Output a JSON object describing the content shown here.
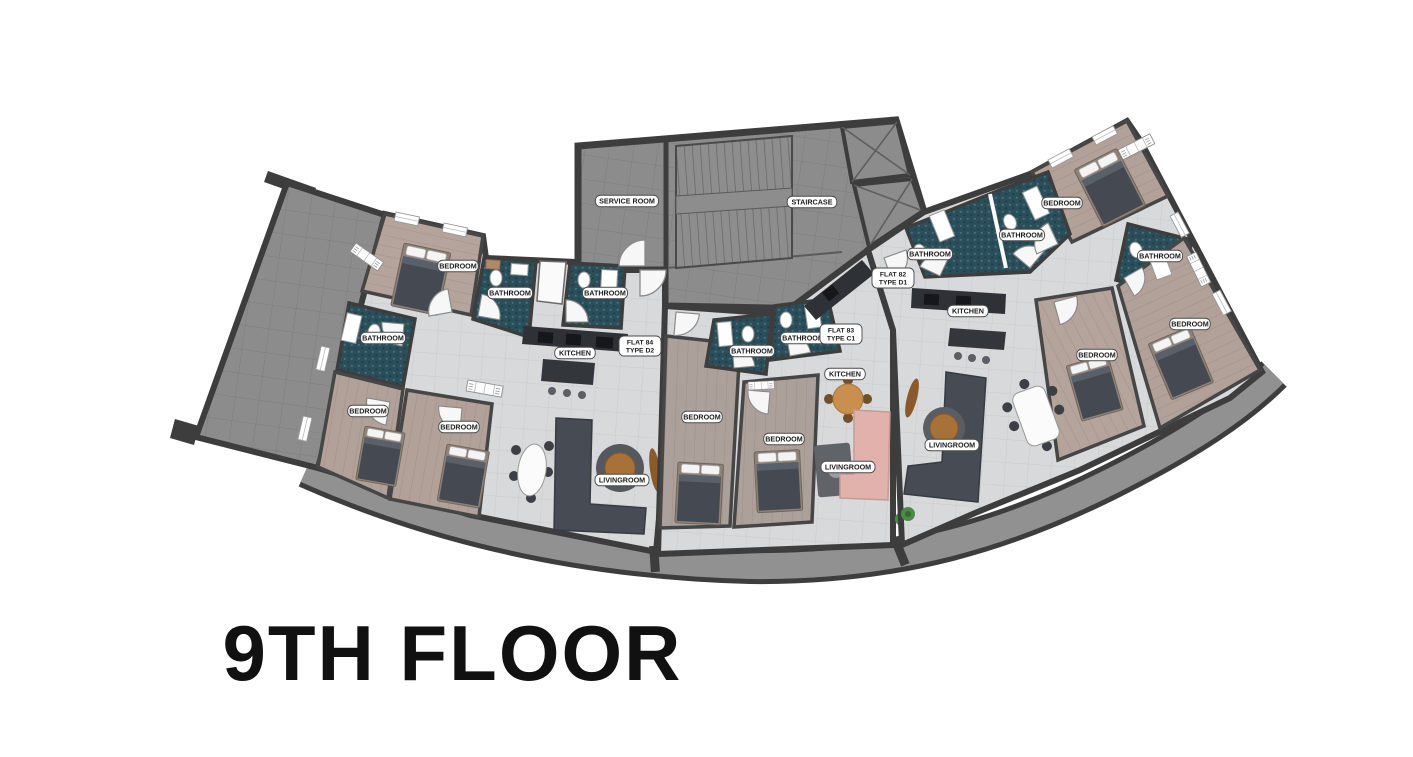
{
  "title": "9TH FLOOR",
  "colors": {
    "wall": "#3d3d3d",
    "terrace_gray": "#8c8c8c",
    "bathroom_teal": "#2b4f5a",
    "bedroom_wood": "#b1a199",
    "living_tile": "#d8d9da",
    "sofa_dark": "#474c54",
    "sofa_pink": "#e0b2ab",
    "table_wood": "#a87137",
    "label_bg": "#ffffff"
  },
  "core": {
    "service_room_label": "SERVICE ROOM",
    "staircase_label": "STAIRCASE"
  },
  "flat_labels": [
    {
      "line1": "FLAT 84",
      "line2": "TYPE D2",
      "x": 640,
      "y": 346
    },
    {
      "line1": "FLAT 83",
      "line2": "TYPE C1",
      "x": 841,
      "y": 334
    },
    {
      "line1": "FLAT 82",
      "line2": "TYPE D1",
      "x": 893,
      "y": 278
    }
  ],
  "room_labels": [
    {
      "text": "SERVICE ROOM",
      "x": 627,
      "y": 201
    },
    {
      "text": "STAIRCASE",
      "x": 812,
      "y": 202
    },
    {
      "text": "BEDROOM",
      "x": 458,
      "y": 266
    },
    {
      "text": "BATHROOM",
      "x": 510,
      "y": 293
    },
    {
      "text": "BATHROOM",
      "x": 605,
      "y": 293
    },
    {
      "text": "BATHROOM",
      "x": 383,
      "y": 338
    },
    {
      "text": "KITCHEN",
      "x": 575,
      "y": 353
    },
    {
      "text": "BEDROOM",
      "x": 368,
      "y": 411
    },
    {
      "text": "BEDROOM",
      "x": 459,
      "y": 427
    },
    {
      "text": "LIVINGROOM",
      "x": 622,
      "y": 480
    },
    {
      "text": "BATHROOM",
      "x": 752,
      "y": 351
    },
    {
      "text": "BATHROOM",
      "x": 803,
      "y": 338
    },
    {
      "text": "KITCHEN",
      "x": 845,
      "y": 374
    },
    {
      "text": "BEDROOM",
      "x": 702,
      "y": 417
    },
    {
      "text": "BEDROOM",
      "x": 784,
      "y": 439
    },
    {
      "text": "LIVINGROOM",
      "x": 848,
      "y": 467
    },
    {
      "text": "BATHROOM",
      "x": 930,
      "y": 254
    },
    {
      "text": "BATHROOM",
      "x": 1022,
      "y": 235
    },
    {
      "text": "BEDROOM",
      "x": 1062,
      "y": 203
    },
    {
      "text": "KITCHEN",
      "x": 968,
      "y": 311
    },
    {
      "text": "LIVINGROOM",
      "x": 952,
      "y": 445
    },
    {
      "text": "BATHROOM",
      "x": 1160,
      "y": 256
    },
    {
      "text": "BEDROOM",
      "x": 1190,
      "y": 324
    },
    {
      "text": "BEDROOM",
      "x": 1097,
      "y": 355
    }
  ]
}
